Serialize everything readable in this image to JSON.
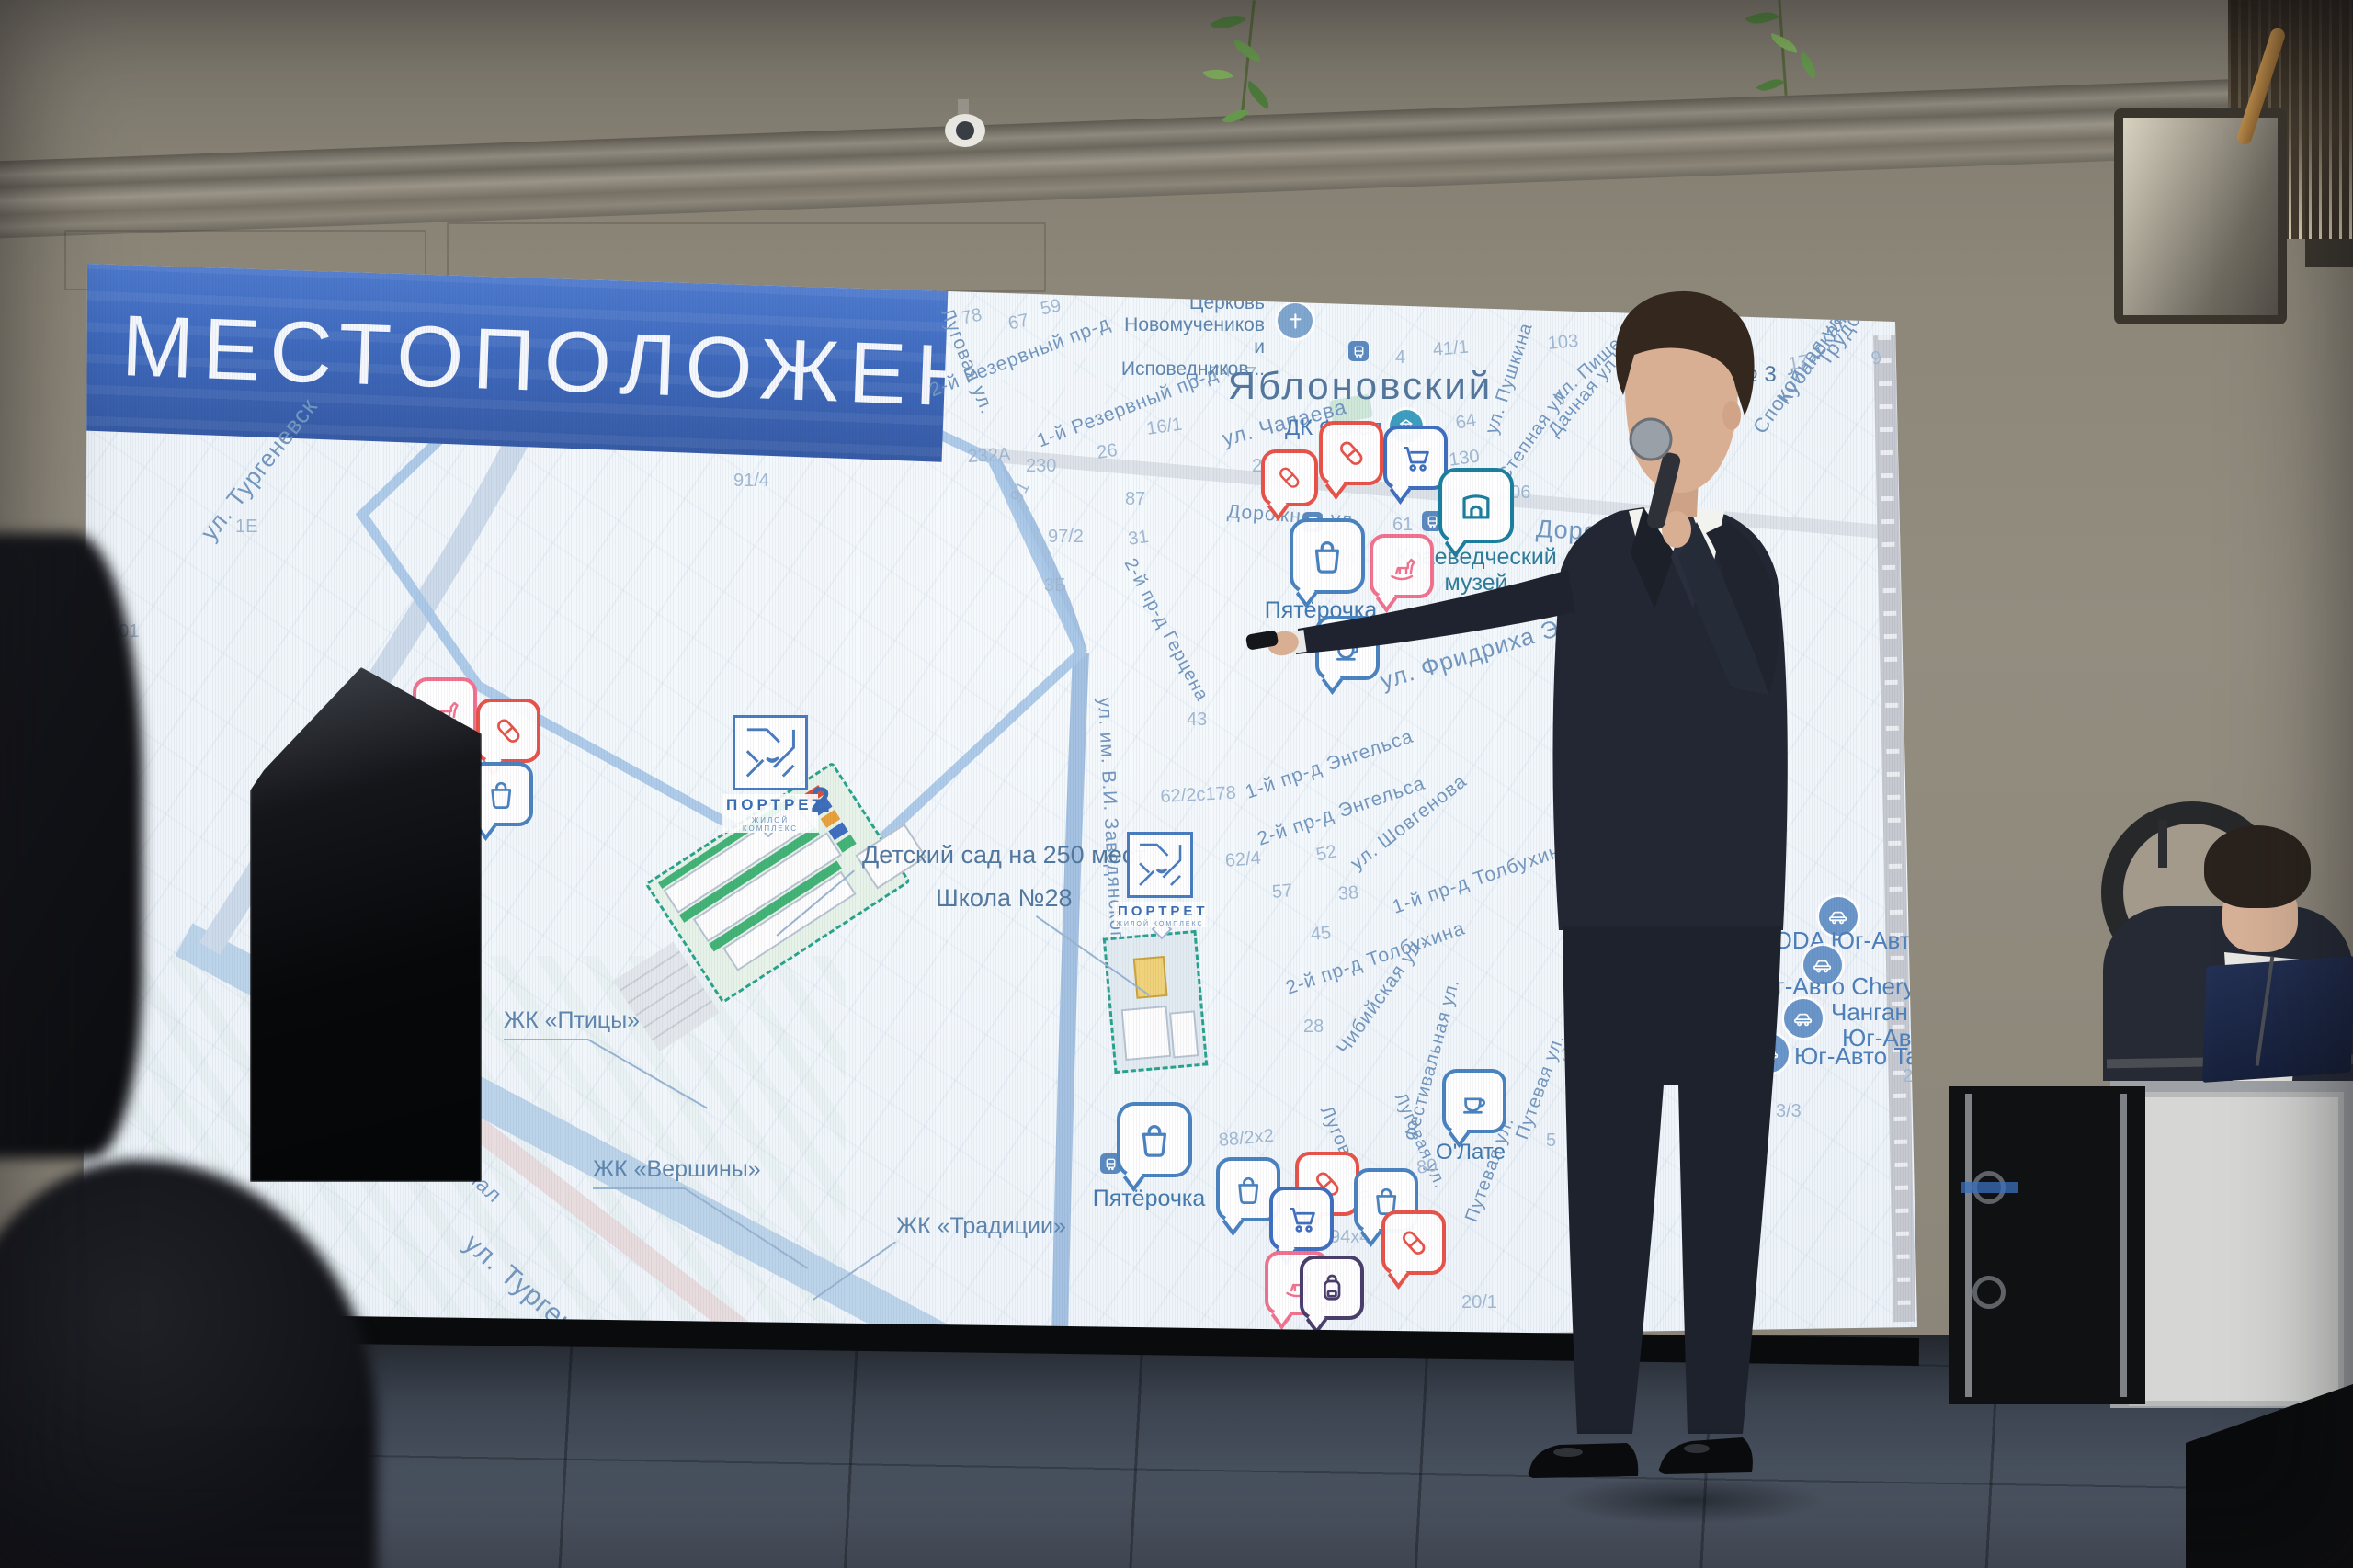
{
  "slide": {
    "title": "МЕСТОПОЛОЖЕНИЕ",
    "accent_color": "#3f66b0",
    "map": {
      "town": "Яблоновский",
      "church_lines": [
        "Церковь",
        "Новомучеников",
        "и Исповедников..."
      ],
      "museum_lines": [
        "Краеведческий",
        "музей"
      ],
      "labels": {
        "dk": "ДК Факел",
        "school3": "Школа № 3",
        "pyaterochka_top": "Пятёрочка",
        "pyaterochka_bottom": "Пятёрочка",
        "coffee": "О'Лате"
      },
      "callouts": {
        "kindergarten": "Детский сад на 250 мест",
        "school28": "Школа №28"
      },
      "complexes": [
        "ЖК «Птицы»",
        "ЖК «Вершины»",
        "ЖК «Традиции»"
      ],
      "dealer_labels": [
        "MODA Юг-Авто",
        "Юг-Авто Chery",
        "Чанган Центр",
        "Юг-Авто",
        "Юг-Авто Tank"
      ],
      "logo": {
        "name": "ПОРТРЕТ",
        "subtitle": "ЖИЛОЙ КОМПЛЕКС",
        "number": "2"
      },
      "icons": {
        "pharmacy": "pill-capsule",
        "supermarket": "shopping-bag",
        "hypermarket": "shopping-cart",
        "museum": "arch-gate",
        "kids": "rocking-horse",
        "coffee": "coffee-cup",
        "school_goods": "backpack",
        "church": "cross",
        "culture": "columns",
        "school": "graduation-cap",
        "dealer": "car",
        "bus_stop": "bus"
      },
      "streets": [
        "ул. Тургеневск",
        "ул. Тургеневское Шосс",
        "ский канал",
        "ул. Чапаева",
        "Дорожная ул.",
        "Дорожная ул.",
        "1-й Резервный пр-д",
        "2-й Резервный пр-д",
        "Луговая ул.",
        "2-й пр-д Герцена",
        "ул. Фридриха Энгельса",
        "1-й пр-д Энгельса",
        "2-й пр-д Энгельса",
        "ул. Шовгенова",
        "1-й пр-д Толбухина",
        "2-й пр-д Толбухина",
        "Чибийская ул.",
        "ул. им. В.И. Заводянского",
        "ул. Пушкина",
        "Дачная ул.",
        "Степная ул.",
        "Трудовая ул.",
        "Кубанская ул.",
        "Спокойная ул.",
        "Почтовая ул.",
        "Фестивальная ул.",
        "Луговая ул.",
        "Путевая ул.",
        "Путевая ул.",
        "Луговая ул.",
        "ул. Пище..."
      ],
      "numbers": [
        "91/4",
        "101",
        "1Е",
        "232А",
        "230",
        "16/1",
        "26",
        "87",
        "97/2",
        "91",
        "3Б",
        "31",
        "78",
        "67",
        "59",
        "74",
        "7",
        "4",
        "41/1",
        "103",
        "216",
        "64",
        "130",
        "61",
        "206",
        "24",
        "30",
        "43",
        "62/2с178",
        "62/4",
        "57",
        "38",
        "45",
        "52",
        "7/5",
        "28",
        "88/2х2",
        "94х4",
        "80",
        "39/2",
        "5",
        "17",
        "18",
        "9",
        "2",
        "3/3",
        "20/1"
      ]
    }
  }
}
